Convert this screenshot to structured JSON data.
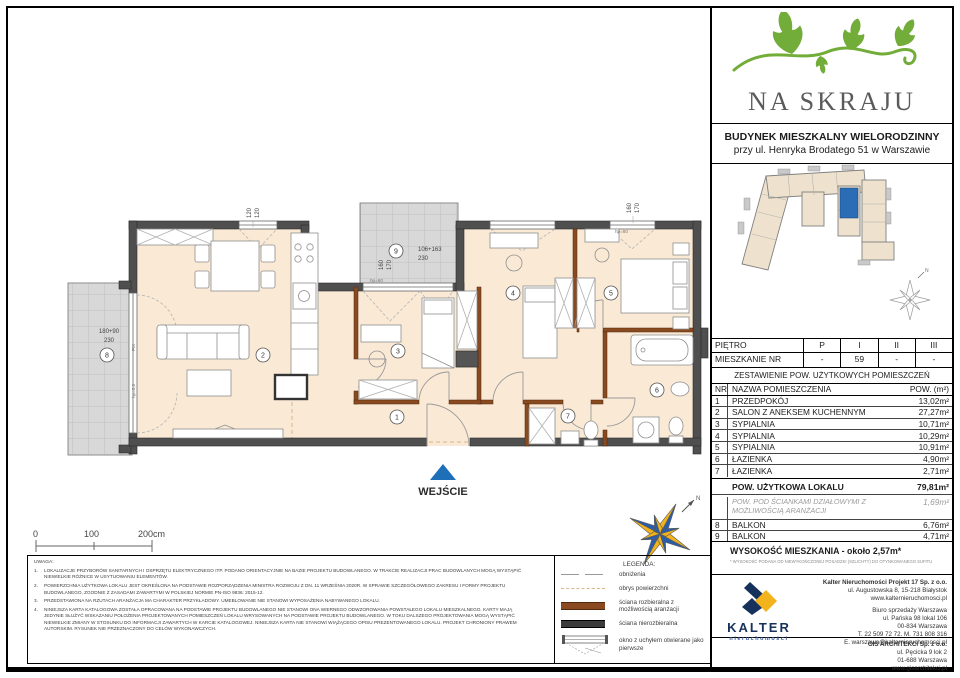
{
  "colors": {
    "floor_beige": "#f9e9d5",
    "wall_dark": "#4f4f4f",
    "wall_demountable_brown": "#8a4a20",
    "balcony_gray": "#d8d8d8",
    "accent_blue": "#1d6fb8",
    "logo_green": "#72ac39",
    "kalter_navy": "#16325c",
    "kalter_yellow": "#f2b31c"
  },
  "header": {
    "logo_title": "NA SKRAJU",
    "building_line1": "BUDYNEK MIESZKALNY WIELORODZINNY",
    "building_line2": "przy ul. Henryka Brodatego 51 w Warszawie"
  },
  "floor_table": {
    "floor_label": "PIĘTRO",
    "floors": [
      "P",
      "I",
      "II",
      "III"
    ],
    "apt_label": "MIESZKANIE NR",
    "apt_values": [
      "-",
      "59",
      "-",
      "-"
    ]
  },
  "rooms_table": {
    "title": "ZESTAWIENIE POW. UŻYTKOWYCH POMIESZCZEŃ",
    "col_nr": "NR",
    "col_name": "NAZWA POMIESZCZENIA",
    "col_area": "POW. (m²)",
    "rows": [
      {
        "nr": "1",
        "name": "PRZEDPOKÓJ",
        "area": "13,02m²"
      },
      {
        "nr": "2",
        "name": "SALON Z ANEKSEM KUCHENNYM",
        "area": "27,27m²"
      },
      {
        "nr": "3",
        "name": "SYPIALNIA",
        "area": "10,71m²"
      },
      {
        "nr": "4",
        "name": "SYPIALNIA",
        "area": "10,29m²"
      },
      {
        "nr": "5",
        "name": "SYPIALNIA",
        "area": "10,91m²"
      },
      {
        "nr": "6",
        "name": "ŁAZIENKA",
        "area": "4,90m²"
      },
      {
        "nr": "7",
        "name": "ŁAZIENKA",
        "area": "2,71m²"
      }
    ],
    "total_label": "POW. UŻYTKOWA LOKALU",
    "total_value": "79,81m²",
    "partition_label": "POW. POD ŚCIANKAMI DZIAŁOWYMI Z MOŻLIWOŚCIĄ ARANŻACJI",
    "partition_value": "1,69m²",
    "balcony_rows": [
      {
        "nr": "8",
        "name": "BALKON",
        "area": "6,76m²"
      },
      {
        "nr": "9",
        "name": "BALKON",
        "area": "4,71m²"
      }
    ],
    "height_label": "WYSOKOŚĆ MIESZKANIA - około 2,57m*",
    "height_footnote": "* WYSOKOŚĆ PODANA OD NIEWYKOŃCZONEJ POSADZKI (SZLICHTY) DO OTYNKOWANEGO SUFITU"
  },
  "companies": {
    "kalter_name": "KALTER",
    "kalter_sub": "nieruchomości",
    "hq_line1": "Kalter Nieruchomości Projekt 17 Sp. z o.o.",
    "hq_line2": "ul. Augustowska 8, 15-218 Białystok",
    "hq_line3": "www.kalternieruchomosci.pl",
    "office_line1": "Biuro sprzedaży Warszawa",
    "office_line2": "ul. Pańska 98 lokal 106",
    "office_line3": "00-834 Warszawa",
    "office_line4": "T. 22 509 72 72. M. 731 808 316",
    "office_line5": "E. warszawa@kalternieruchomosci.pl",
    "gis_line1": "GIS ARCHITEKCI Sp. z o.o.",
    "gis_line2": "ul. Pęcicka 9 lok 2",
    "gis_line3": "01-688 Warszawa",
    "gis_line4": "www.gisarchitekci.pl"
  },
  "plan": {
    "entrance": "WEJŚCIE",
    "north": "N",
    "rooms": {
      "r1": "1",
      "r2": "2",
      "r3": "3",
      "r4": "4",
      "r5": "5",
      "r6": "6",
      "r7": "7",
      "r8": "8",
      "r9": "9"
    },
    "dims": {
      "salon_window_a": "120",
      "salon_window_b": "120",
      "balcony8_line1": "180+90",
      "balcony8_line2": "230",
      "balcony9_line1": "106+163",
      "balcony9_line2": "230",
      "balcony9_side_a": "160",
      "balcony9_side_b": "170",
      "bedroom5_window_a": "160",
      "bedroom5_window_b": "170",
      "fix": "FIX",
      "hp60_a": "hp=60",
      "hp60_b": "hp=60",
      "hp00": "hp=0,0"
    },
    "scale_ticks": [
      "0",
      "100",
      "200cm"
    ]
  },
  "legend": {
    "title": "LEGENDA:",
    "items": [
      "obniżenia",
      "obrys powierzchni",
      "ściana rozbieralna z możliwością aranżacji",
      "ściana nierozbieralna",
      "okno z uchyłem otwierane jako pierwsze"
    ]
  },
  "notes": {
    "title": "UWAGA:",
    "items": [
      {
        "num": "1.",
        "text": "LOKALIZACJE PRZYBORÓW SANITARNYCH I OSPRZĘTU ELEKTRYCZNEGO ITP. PODANO ORIENTACYJNIE NA BAZIE PROJEKTU BUDOWLANEGO. W TRAKCIE REALIZACJI PRAC BUDOWLANYCH MOGĄ WYSTĄPIĆ NIEWIELKIE RÓŻNICE W USYTUOWANIU ELEMENTÓW."
      },
      {
        "num": "2.",
        "text": "POWIERZCHNIA UŻYTKOWA LOKALU JEST OKREŚLONA NA PODSTAWIE ROZPORZĄDZENIA MINISTRA ROZWOJU Z DN. 11 WRZEŚNIA 2020R. W SPRAWIE SZCZEGÓŁOWEGO ZAKRESU I FORMY PROJEKTU BUDOWLANEGO, ZGODNIE Z ZASADAMI ZAWARTYMI W POLSKIEJ NORMIE PN-ISO 9836: 2015-12."
      },
      {
        "num": "3.",
        "text": "PRZEDSTAWIONA NA RZUTACH ARANŻACJA MA CHARAKTER PRZYKŁADOWY. UMEBLOWANIE NIE STANOWI WYPOSAŻENIA NABYWANEGO LOKALU."
      },
      {
        "num": "4.",
        "text": "NINIEJSZA KARTA KATALOGOWA ZOSTAŁA OPRACOWANA NA PODSTAWIE PROJEKTU BUDOWLANEGO NIE STANOWI ONA WIERNEGO ODWZOROWANIA POWSTAŁEGO LOKALU MIESZKALNEGO. KARTY MAJĄ JEDYNIE SŁUŻYĆ WSKAZANIU POŁOŻENIA PROJEKTOWANYCH POMIESZCZEŃ LOKALU WRYSOWANYCH NA PODSTAWIE PROJEKTU BUDOWLANEGO. W TOKU DALSZEGO PROJEKTOWANIA MOGĄ WYSTĄPIĆ NIEWIELKIE ZMIANY W STOSUNKU DO INFORMACJI ZAWARTYCH W KARCIE KATALOGOWEJ. NINIEJSZA KARTA NIE STANOWI WIĄŻĄCEGO OPISU PREZENTOWANEGO LOKALU. PROJEKT CHRONIONY PRAWEM AUTORSKIM. RYSUNEK NIE PRZEZNACZONY DO CELÓW WYKONAWCZYCH."
      }
    ]
  }
}
